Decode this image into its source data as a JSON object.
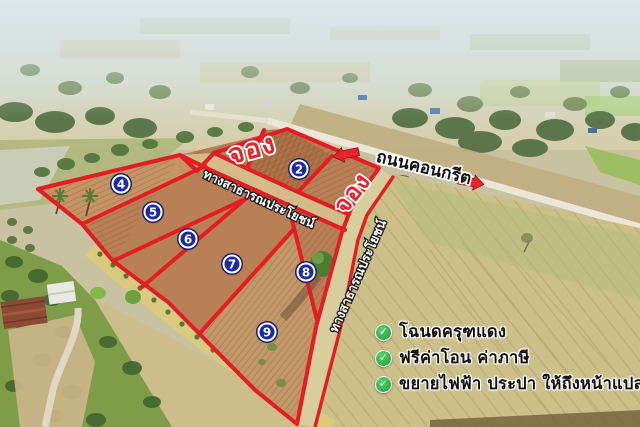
{
  "labels": {
    "reserved_1": "จอง",
    "reserved_2": "จอง",
    "concrete_road": "ถนนคอนกรีต",
    "public_way_1": "ทางสาธารณประโยชน์",
    "public_way_2": "ทางสาธารณประโยชน์"
  },
  "plot_numbers": [
    "2",
    "4",
    "5",
    "6",
    "7",
    "8",
    "9"
  ],
  "features": [
    {
      "icon": "check",
      "text": "โฉนดครุฑแดง"
    },
    {
      "icon": "check",
      "text": "ฟรีค่าโอน ค่าภาษี"
    },
    {
      "icon": "check",
      "text": "ขยายไฟฟ้า ประปา ให้ถึงหน้าแปลง"
    }
  ],
  "check_glyph": "✓",
  "colors": {
    "boundary_red": "#e41d22",
    "badge_blue": "#1b2aa6",
    "check_green": "#2fb54b",
    "reserved_red": "#e5232b"
  }
}
